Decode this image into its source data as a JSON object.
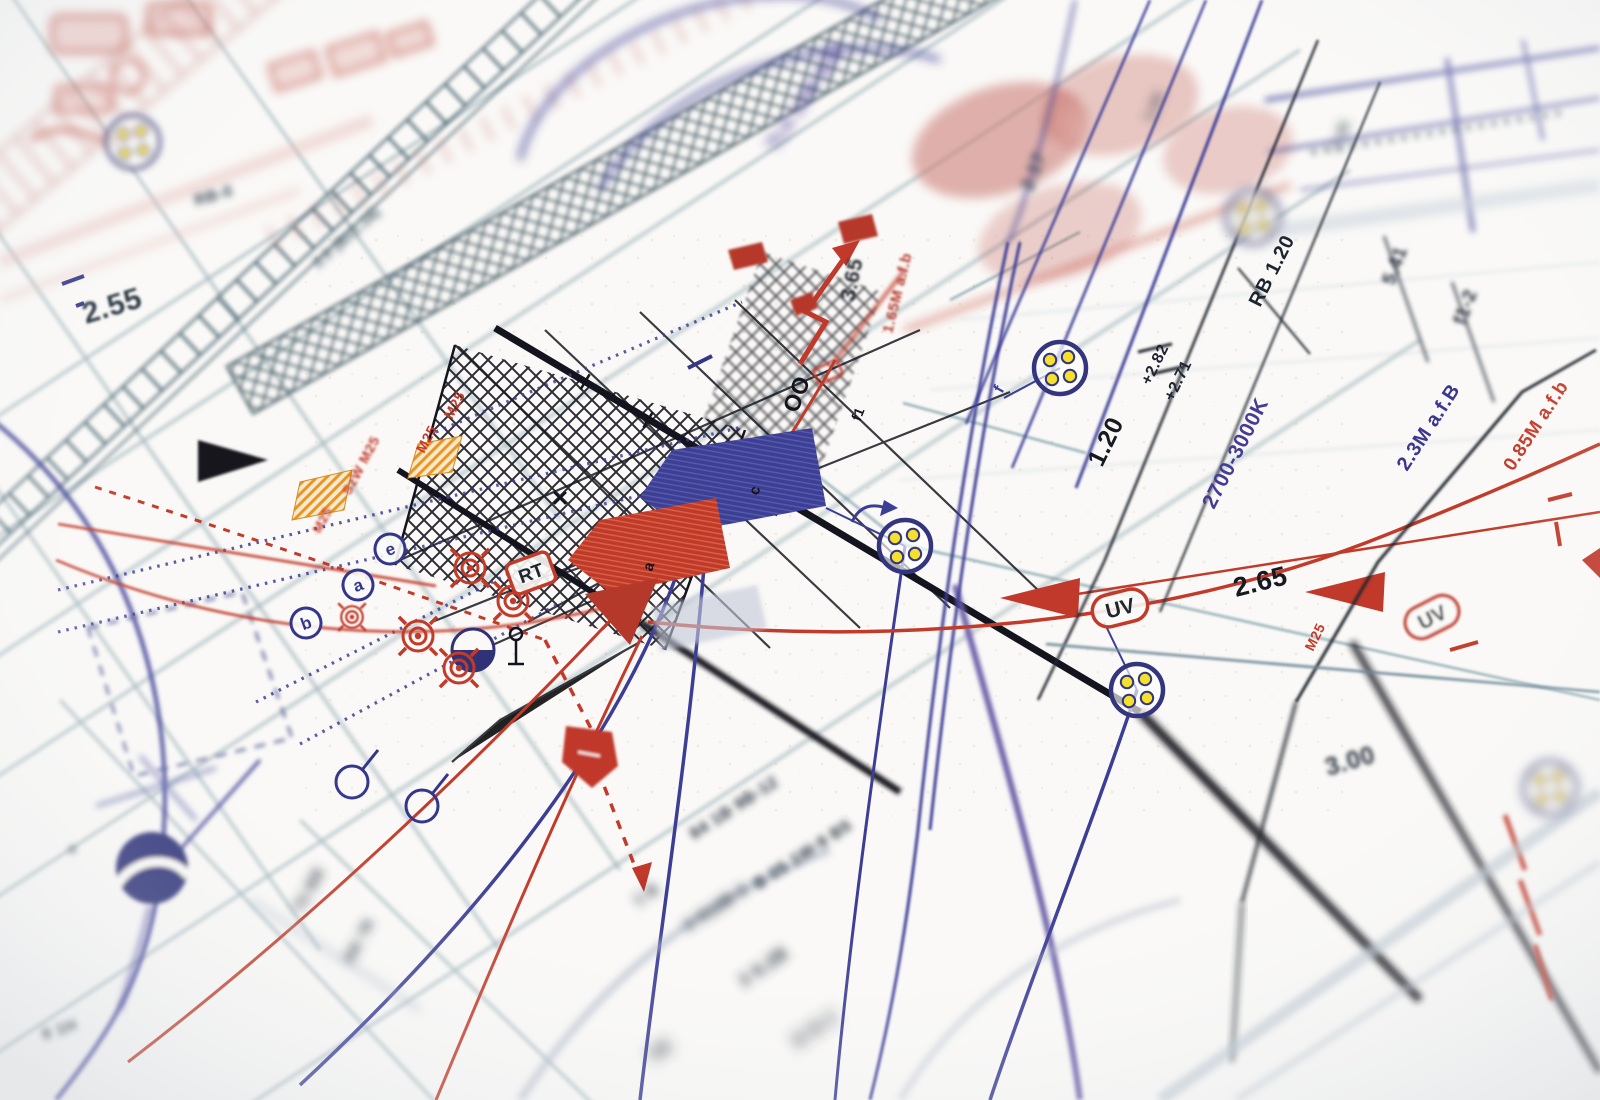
{
  "photo": {
    "subject": "electrical lighting installation plan, close-up photograph with shallow depth of field"
  },
  "colors": {
    "paper": "#faf9f7",
    "navy": "#34368c",
    "indigo": "#463c94",
    "purple": "#564a9e",
    "red": "#c23b2a",
    "dark_red": "#b5392b",
    "black_ink": "#14141e",
    "teal": "#44606b",
    "steel": "#6a8b97",
    "yellow_dot": "#f5e02d",
    "orange": "#e8952a"
  },
  "labels": [
    {
      "t": "2.55",
      "x": 86,
      "y": 324,
      "r": -17,
      "s": 30,
      "c": "#232e3a",
      "b": 1
    },
    {
      "t": "RB-0",
      "x": 196,
      "y": 206,
      "r": -16,
      "s": 16,
      "c": "#33414f",
      "b": 3
    },
    {
      "t": "2.0 (B±1.18)",
      "x": 318,
      "y": 268,
      "r": -41,
      "s": 14,
      "c": "#2f4653",
      "b": 3
    },
    {
      "t": "3.65",
      "x": 854,
      "y": 302,
      "r": -78,
      "s": 21,
      "c": "#20262e",
      "b": 1
    },
    {
      "t": "1.65M a.f.b",
      "x": 892,
      "y": 334,
      "r": -76,
      "s": 15,
      "c": "#b5392b",
      "b": 1
    },
    {
      "t": "OO",
      "x": 797,
      "y": 414,
      "r": -68,
      "s": 23,
      "c": "#14141e",
      "b": 0
    },
    {
      "t": "f1",
      "x": 860,
      "y": 422,
      "r": -68,
      "s": 14,
      "c": "#14141e",
      "b": 0
    },
    {
      "t": "f",
      "x": 1002,
      "y": 394,
      "r": -60,
      "s": 16,
      "c": "#3d3d96",
      "b": 0
    },
    {
      "t": "c",
      "x": 758,
      "y": 496,
      "r": -72,
      "s": 15,
      "c": "#14141e",
      "b": 0
    },
    {
      "t": "a",
      "x": 652,
      "y": 572,
      "r": -72,
      "s": 15,
      "c": "#14141e",
      "b": 0
    },
    {
      "t": "RB 1.20",
      "x": 1260,
      "y": 308,
      "r": -63,
      "s": 20,
      "c": "#1d2430",
      "b": 0
    },
    {
      "t": "+2.82",
      "x": 1150,
      "y": 386,
      "r": -64,
      "s": 16,
      "c": "#1d2430",
      "b": 0
    },
    {
      "t": "+2.71",
      "x": 1173,
      "y": 402,
      "r": -64,
      "s": 16,
      "c": "#1d2430",
      "b": 0
    },
    {
      "t": "1.20",
      "x": 1102,
      "y": 468,
      "r": -64,
      "s": 25,
      "c": "#161a20",
      "b": 0
    },
    {
      "t": "2700-3000K",
      "x": 1214,
      "y": 510,
      "r": -63,
      "s": 21,
      "c": "#463c94",
      "b": 0
    },
    {
      "t": "2.65",
      "x": 1236,
      "y": 597,
      "r": -14,
      "s": 27,
      "c": "#161a20",
      "b": 0
    },
    {
      "t": "M25",
      "x": 1313,
      "y": 652,
      "r": -64,
      "s": 14,
      "c": "#c23b2a",
      "b": 0
    },
    {
      "t": "0.85M a.f.b",
      "x": 1513,
      "y": 472,
      "r": -57,
      "s": 19,
      "c": "#c23b2a",
      "b": 0
    },
    {
      "t": "2.3M a.f.B",
      "x": 1407,
      "y": 472,
      "r": -57,
      "s": 20,
      "c": "#3c3690",
      "b": 0
    },
    {
      "t": "5.41",
      "x": 1394,
      "y": 286,
      "r": -70,
      "s": 19,
      "c": "#2a3240",
      "b": 2
    },
    {
      "t": "f1-2",
      "x": 1465,
      "y": 326,
      "r": -70,
      "s": 19,
      "c": "#2a3240",
      "b": 2
    },
    {
      "t": "2.17",
      "x": 1032,
      "y": 192,
      "r": -68,
      "s": 19,
      "c": "#3a4a56",
      "b": 3
    },
    {
      "t": "1.61",
      "x": 1152,
      "y": 122,
      "r": -66,
      "s": 15,
      "c": "#3a4a56",
      "b": 4
    },
    {
      "t": "1.45",
      "x": 1338,
      "y": 152,
      "r": -66,
      "s": 15,
      "c": "#3a4a56",
      "b": 4
    },
    {
      "t": "3.00",
      "x": 1328,
      "y": 776,
      "r": -16,
      "s": 25,
      "c": "#2a3240",
      "b": 2
    },
    {
      "t": "M25",
      "x": 452,
      "y": 420,
      "r": -62,
      "s": 14,
      "c": "#c23b2a",
      "b": 0
    },
    {
      "t": "M25",
      "x": 424,
      "y": 454,
      "r": -62,
      "s": 14,
      "c": "#c23b2a",
      "b": 0
    },
    {
      "t": "SzW M25",
      "x": 350,
      "y": 496,
      "r": -62,
      "s": 14,
      "c": "#c23b2a",
      "b": 1
    },
    {
      "t": "M25",
      "x": 320,
      "y": 534,
      "r": -62,
      "s": 13,
      "c": "#c23b2a",
      "b": 1
    },
    {
      "t": "84 1B 9B-12",
      "x": 694,
      "y": 840,
      "r": -33,
      "s": 17,
      "c": "#2d3744",
      "b": 3
    },
    {
      "t": "B 05 1W-9 B5",
      "x": 758,
      "y": 890,
      "r": -33,
      "s": 17,
      "c": "#2d3744",
      "b": 3
    },
    {
      "t": "3 512B 0",
      "x": 688,
      "y": 932,
      "r": -33,
      "s": 17,
      "c": "#2d3744",
      "b": 4
    },
    {
      "t": "1 B",
      "x": 638,
      "y": 906,
      "r": -33,
      "s": 16,
      "c": "#2d3744",
      "b": 4
    },
    {
      "t": "3 9.2B",
      "x": 744,
      "y": 988,
      "r": -35,
      "s": 18,
      "c": "#2d3744",
      "b": 4
    },
    {
      "t": "B B-2",
      "x": 798,
      "y": 1048,
      "r": -35,
      "s": 18,
      "c": "#2d3744",
      "b": 5
    },
    {
      "t": "5B",
      "x": 654,
      "y": 1062,
      "r": -35,
      "s": 18,
      "c": "#2d3744",
      "b": 5
    },
    {
      "t": "T5 BB",
      "x": 302,
      "y": 914,
      "r": -62,
      "s": 16,
      "c": "#2d3744",
      "b": 4
    },
    {
      "t": "BB 7B",
      "x": 352,
      "y": 964,
      "r": -62,
      "s": 15,
      "c": "#2d3744",
      "b": 4
    },
    {
      "t": "8 1H",
      "x": 44,
      "y": 1040,
      "r": -18,
      "s": 16,
      "c": "#2d3744",
      "b": 3
    },
    {
      "t": "a",
      "x": 70,
      "y": 854,
      "r": -20,
      "s": 13,
      "c": "#2d3744",
      "b": 3
    },
    {
      "t": "TL5 14W B30",
      "x": 776,
      "y": 152,
      "r": -56,
      "s": 19,
      "c": "#564a9e",
      "b": 4
    }
  ],
  "boxed_labels": [
    {
      "t": "RT",
      "x": 531,
      "y": 573,
      "r": -20,
      "w": 44,
      "h": 32,
      "rx": 6,
      "box": "#c23b2a",
      "tc": "#20262e",
      "s": 19,
      "b": 0
    },
    {
      "t": "UV",
      "x": 1120,
      "y": 608,
      "r": -14,
      "w": 56,
      "h": 32,
      "rx": 16,
      "box": "#c23b2a",
      "tc": "#20262e",
      "s": 21,
      "b": 0
    },
    {
      "t": "UV",
      "x": 1432,
      "y": 617,
      "r": -27,
      "w": 56,
      "h": 32,
      "rx": 16,
      "box": "#c23b2a",
      "tc": "#20262e",
      "s": 21,
      "b": 1
    }
  ],
  "circled_letters": [
    {
      "t": "e",
      "x": 390,
      "y": 549,
      "r": -20,
      "b": 0
    },
    {
      "t": "a",
      "x": 358,
      "y": 585,
      "r": -20,
      "b": 0
    },
    {
      "t": "b",
      "x": 306,
      "y": 623,
      "r": -20,
      "b": 0
    }
  ],
  "luminaires": [
    {
      "x": 1060,
      "y": 368,
      "b": 0
    },
    {
      "x": 905,
      "y": 546,
      "b": 0
    },
    {
      "x": 1137,
      "y": 690,
      "b": 0
    },
    {
      "x": 133,
      "y": 142,
      "b": 3
    },
    {
      "x": 1253,
      "y": 217,
      "b": 4
    },
    {
      "x": 1550,
      "y": 788,
      "b": 4
    }
  ],
  "targets": [
    {
      "x": 470,
      "y": 568,
      "sc": 1
    },
    {
      "x": 513,
      "y": 601,
      "sc": 1
    },
    {
      "x": 418,
      "y": 636,
      "sc": 1
    },
    {
      "x": 459,
      "y": 668,
      "sc": 1
    },
    {
      "x": 352,
      "y": 617,
      "sc": 0.72,
      "b": 1
    }
  ]
}
